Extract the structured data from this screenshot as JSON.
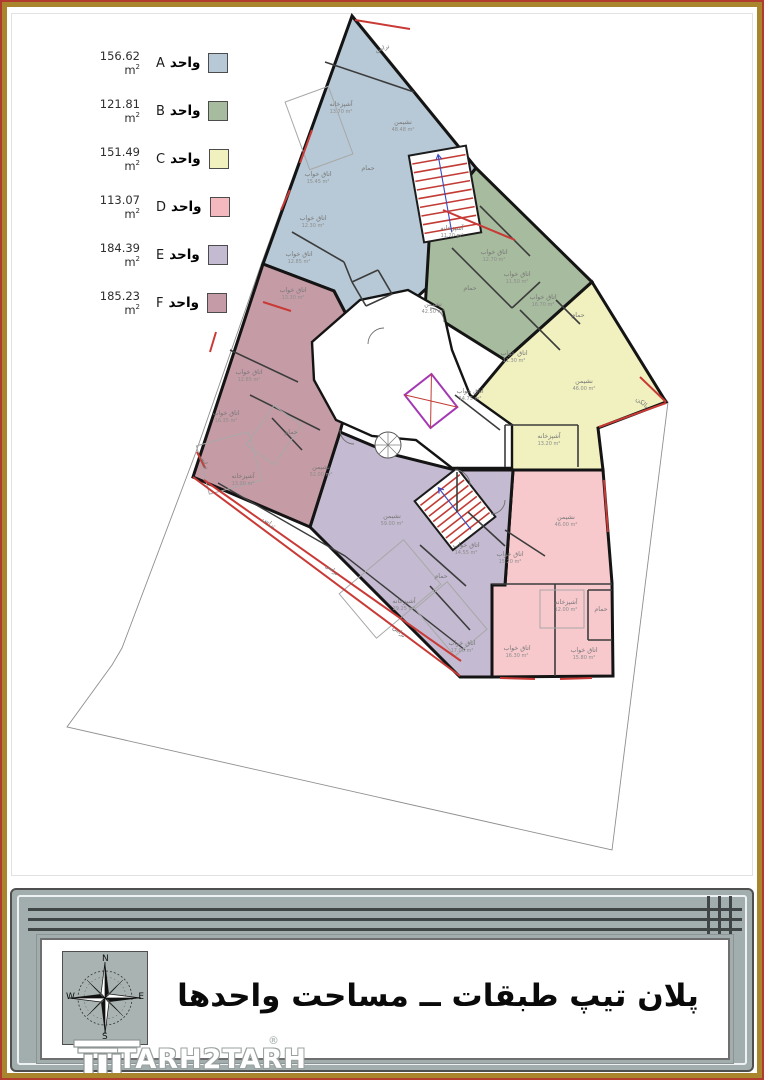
{
  "page": {
    "border_red": "#b23b30",
    "border_gold": "#a9862e"
  },
  "legend": {
    "unit_word": "واحد",
    "area_unit": "m",
    "area_sup": "2",
    "rows": [
      {
        "letter": "A",
        "area": "156.62",
        "color": "#b7c9d6"
      },
      {
        "letter": "B",
        "area": "121.81",
        "color": "#a7bb9e"
      },
      {
        "letter": "C",
        "area": "151.49",
        "color": "#f0f1bf"
      },
      {
        "letter": "D",
        "area": "113.07",
        "color": "#f4b9bf"
      },
      {
        "letter": "E",
        "area": "184.39",
        "color": "#c4bad1"
      },
      {
        "letter": "F",
        "area": "185.23",
        "color": "#c49ba7"
      }
    ]
  },
  "plan": {
    "wall_color": "#141414",
    "lot_color": "#8f8f8f",
    "red": "#c93a36",
    "label_color": "#777777",
    "lot_points": "352,14 668,402 612,850 67,727 112,665 122,648 196,452 262,262",
    "units": [
      {
        "id": "A",
        "color": "#b7c9d6",
        "points": "352,16 476,168 430,225 428,287 363,347 334,291 263,264"
      },
      {
        "id": "B",
        "color": "#a7bb9e",
        "points": "476,168 592,282 505,360 425,310 430,225"
      },
      {
        "id": "C",
        "color": "#f0f1bf",
        "points": "592,282 666,402 598,428 603,470 513,470 455,420 505,360"
      },
      {
        "id": "D",
        "color": "#f7c9cd",
        "points": "513,470 603,470 612,583 613,676 492,677 492,585 505,585"
      },
      {
        "id": "E",
        "color": "#c4bad1",
        "points": "340,432 395,455 455,470 513,470 505,585 492,585 492,677 460,677 310,527"
      },
      {
        "id": "F",
        "color": "#c59ba6",
        "points": "263,264 334,291 363,347 340,432 310,527 193,477"
      }
    ],
    "corridor_points": "312,342 360,300 408,290 443,310 452,350 470,395 512,425 512,468 452,468 416,440 372,436 336,420 314,380",
    "stairs": [
      {
        "x": 416,
        "y": 150,
        "w": 58,
        "h": 88,
        "rot": "-10 445 194",
        "treads": 9
      },
      {
        "x": 428,
        "y": 478,
        "w": 54,
        "h": 62,
        "rot": "-38 455 509",
        "treads": 8
      }
    ],
    "elevator": {
      "x": 414,
      "y": 380,
      "w": 34,
      "h": 42,
      "rot": "-38 431 401",
      "color": "#a438b4"
    },
    "spiral": {
      "cx": 388,
      "cy": 445,
      "r": 13
    },
    "terrace_wall": "218,483 345,556 465,650",
    "thin_walls": [
      [
        325,
        62,
        414,
        92
      ],
      [
        292,
        232,
        344,
        262
      ],
      [
        344,
        262,
        352,
        282
      ],
      [
        352,
        282,
        378,
        270
      ],
      [
        378,
        270,
        392,
        294
      ],
      [
        392,
        294,
        366,
        306
      ],
      [
        366,
        306,
        352,
        282
      ],
      [
        452,
        248,
        512,
        308
      ],
      [
        480,
        206,
        530,
        256
      ],
      [
        512,
        308,
        540,
        282
      ],
      [
        520,
        310,
        560,
        350
      ],
      [
        556,
        300,
        580,
        324
      ],
      [
        455,
        395,
        500,
        430
      ],
      [
        505,
        425,
        505,
        467
      ],
      [
        505,
        425,
        578,
        425
      ],
      [
        578,
        425,
        578,
        467
      ],
      [
        492,
        584,
        612,
        584
      ],
      [
        555,
        584,
        555,
        676
      ],
      [
        588,
        590,
        612,
        590
      ],
      [
        588,
        590,
        588,
        640
      ],
      [
        588,
        640,
        612,
        640
      ],
      [
        505,
        530,
        545,
        556
      ],
      [
        420,
        545,
        466,
        586
      ],
      [
        468,
        512,
        505,
        546
      ],
      [
        430,
        586,
        470,
        630
      ],
      [
        457,
        472,
        457,
        512
      ],
      [
        230,
        350,
        298,
        382
      ],
      [
        250,
        395,
        320,
        430
      ],
      [
        272,
        418,
        302,
        450
      ]
    ],
    "red_lines": [
      [
        355,
        20,
        410,
        29
      ],
      [
        300,
        163,
        312,
        130
      ],
      [
        281,
        210,
        290,
        190
      ],
      [
        640,
        377,
        666,
        402
      ],
      [
        666,
        403,
        599,
        427
      ],
      [
        604,
        480,
        608,
        532
      ],
      [
        500,
        678,
        535,
        679
      ],
      [
        560,
        679,
        592,
        678
      ],
      [
        197,
        452,
        205,
        468
      ],
      [
        210,
        352,
        216,
        332
      ],
      [
        263,
        302,
        291,
        311
      ],
      [
        443,
        210,
        515,
        240
      ],
      [
        193,
        477,
        460,
        676
      ],
      [
        204,
        480,
        461,
        661
      ]
    ],
    "furniture": [
      [
        296,
        92,
        46,
        72,
        -20
      ],
      [
        348,
        560,
        84,
        58,
        -40
      ],
      [
        202,
        438,
        54,
        50,
        -15
      ],
      [
        430,
        588,
        42,
        62,
        -40
      ],
      [
        540,
        590,
        44,
        38,
        0
      ],
      [
        250,
        418,
        48,
        34,
        -55
      ]
    ],
    "arcs": [
      "M368,344 a16,16 0 0 1 16,-16",
      "M455,470 a15,15 0 0 1 15,15",
      "M430,308 a14,14 0 0 1 14,14",
      "M340,430 a14,14 0 0 0 14,14",
      "M505,500 a14,14 0 0 1 -14,14"
    ],
    "rooms": [
      {
        "n": "تراس",
        "a": "",
        "x": 383,
        "y": 50,
        "r": -18
      },
      {
        "n": "آشپزخانه",
        "a": "13.70 m²",
        "x": 341,
        "y": 106,
        "r": 0
      },
      {
        "n": "نشیمن",
        "a": "48.48 m²",
        "x": 403,
        "y": 124,
        "r": 0
      },
      {
        "n": "اتاق خواب",
        "a": "15.45 m²",
        "x": 318,
        "y": 176,
        "r": 0
      },
      {
        "n": "حمام",
        "a": "",
        "x": 368,
        "y": 170,
        "r": 0
      },
      {
        "n": "اتاق خواب",
        "a": "12.30 m²",
        "x": 313,
        "y": 220,
        "r": 0
      },
      {
        "n": "اتاق خواب",
        "a": "12.85 m²",
        "x": 299,
        "y": 256,
        "r": 0
      },
      {
        "n": "آشپزخانه",
        "a": "11.20 m²",
        "x": 452,
        "y": 230,
        "r": 0
      },
      {
        "n": "اتاق خواب",
        "a": "12.70 m²",
        "x": 494,
        "y": 254,
        "r": 0
      },
      {
        "n": "اتاق خواب",
        "a": "11.50 m²",
        "x": 517,
        "y": 276,
        "r": 0
      },
      {
        "n": "حمام",
        "a": "",
        "x": 470,
        "y": 290,
        "r": 0
      },
      {
        "n": "نشیمن",
        "a": "42.50 m²",
        "x": 433,
        "y": 306,
        "r": 0
      },
      {
        "n": "اتاق خواب",
        "a": "16.70 m²",
        "x": 543,
        "y": 299,
        "r": 0
      },
      {
        "n": "حمام",
        "a": "",
        "x": 578,
        "y": 317,
        "r": 0
      },
      {
        "n": "اتاق خواب",
        "a": "11.30 m²",
        "x": 514,
        "y": 355,
        "r": 0
      },
      {
        "n": "نشیمن",
        "a": "46.00 m²",
        "x": 584,
        "y": 383,
        "r": 0
      },
      {
        "n": "بالکن",
        "a": "",
        "x": 641,
        "y": 404,
        "r": 40
      },
      {
        "n": "اتاق خواب",
        "a": "14.75 m²",
        "x": 470,
        "y": 393,
        "r": 0
      },
      {
        "n": "آشپزخانه",
        "a": "13.20 m²",
        "x": 549,
        "y": 438,
        "r": 0
      },
      {
        "n": "نشیمن",
        "a": "46.00 m²",
        "x": 566,
        "y": 519,
        "r": 0
      },
      {
        "n": "اتاق خواب",
        "a": "15.20 m²",
        "x": 510,
        "y": 556,
        "r": 0
      },
      {
        "n": "حمام",
        "a": "",
        "x": 601,
        "y": 611,
        "r": 0
      },
      {
        "n": "آشپزخانه",
        "a": "12.00 m²",
        "x": 566,
        "y": 604,
        "r": 0
      },
      {
        "n": "اتاق خواب",
        "a": "16.30 m²",
        "x": 517,
        "y": 650,
        "r": 0
      },
      {
        "n": "اتاق خواب",
        "a": "15.80 m²",
        "x": 584,
        "y": 652,
        "r": 0
      },
      {
        "n": "نشیمن",
        "a": "59.00 m²",
        "x": 392,
        "y": 518,
        "r": 0
      },
      {
        "n": "اتاق خواب",
        "a": "14.55 m²",
        "x": 466,
        "y": 547,
        "r": 0
      },
      {
        "n": "حمام",
        "a": "",
        "x": 441,
        "y": 578,
        "r": 0
      },
      {
        "n": "آشپزخانه",
        "a": "29.25 m²",
        "x": 404,
        "y": 603,
        "r": 0
      },
      {
        "n": "اتاق خواب",
        "a": "17.00 m²",
        "x": 462,
        "y": 645,
        "r": 0
      },
      {
        "n": "اتاق خواب",
        "a": "13.30 m²",
        "x": 293,
        "y": 292,
        "r": 0
      },
      {
        "n": "اتاق خواب",
        "a": "12.85 m²",
        "x": 249,
        "y": 374,
        "r": 0
      },
      {
        "n": "اتاق خواب",
        "a": "16.35 m²",
        "x": 226,
        "y": 415,
        "r": 0
      },
      {
        "n": "حمام",
        "a": "",
        "x": 291,
        "y": 434,
        "r": 0
      },
      {
        "n": "نشیمن",
        "a": "52.00 m²",
        "x": 321,
        "y": 469,
        "r": 0
      },
      {
        "n": "آشپزخانه",
        "a": "13.00 m²",
        "x": 243,
        "y": 478,
        "r": 0
      },
      {
        "n": "تراس",
        "a": "",
        "x": 203,
        "y": 463,
        "r": 70
      },
      {
        "n": "تراس",
        "a": "",
        "x": 268,
        "y": 524,
        "r": 38
      },
      {
        "n": "تراس",
        "a": "",
        "x": 331,
        "y": 571,
        "r": 40
      },
      {
        "n": "تراس",
        "a": "",
        "x": 398,
        "y": 633,
        "r": 42
      }
    ]
  },
  "titleblock": {
    "title": "پلان تیپ طبقات ــ مساحت واحدها",
    "brand": "TARH2TARH",
    "brand_reg": "®",
    "brand_sub": "ALL RIGHT RESERVED",
    "compass": {
      "n": "N",
      "e": "E",
      "w": "W",
      "s": "S"
    }
  }
}
